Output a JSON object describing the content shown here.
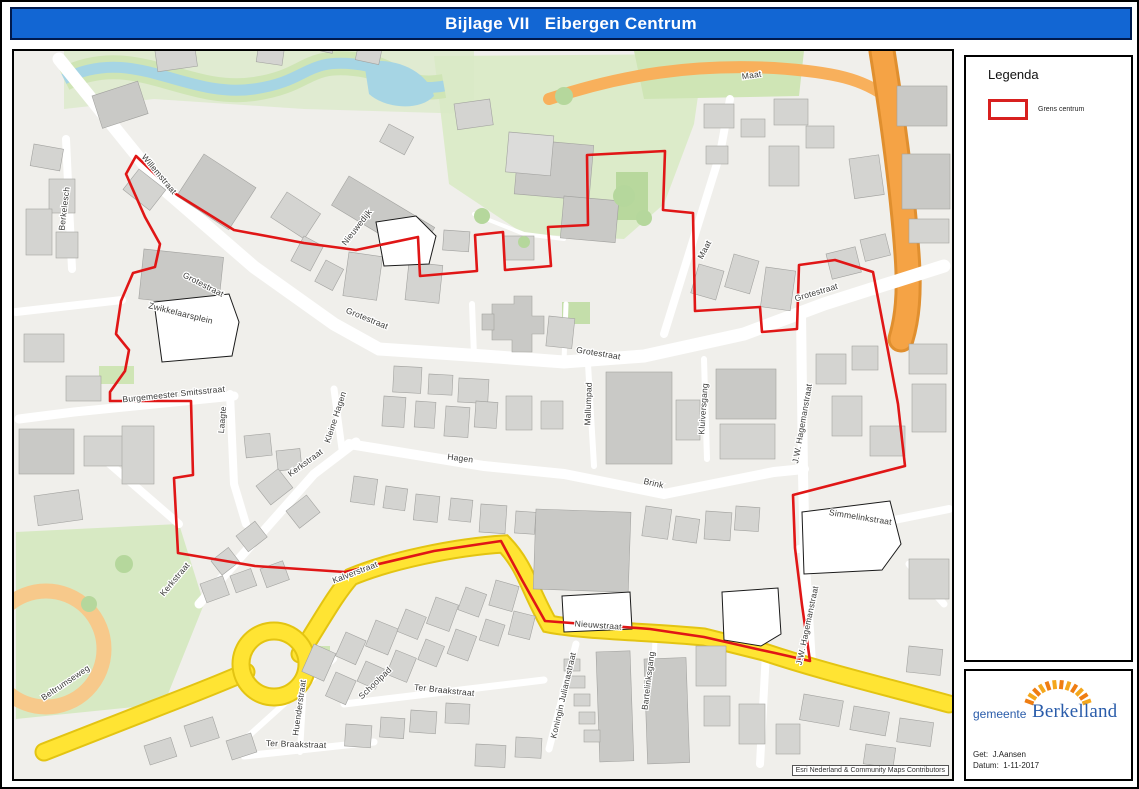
{
  "title_bar": {
    "text": "Bijlage VII   Eibergen Centrum",
    "bg_color": "#1266d3",
    "text_color": "#ffffff"
  },
  "legend": {
    "heading": "Legenda",
    "items": [
      {
        "label": "Grens centrum",
        "swatch_outline_color": "#d8201f"
      }
    ]
  },
  "footer_box": {
    "municipality_prefix": "gemeente",
    "municipality_name": "Berkelland",
    "logo_accent_color": "#f08a19",
    "logo_text_color": "#2a5caa",
    "drawn_by_line": "Get:  J.Aansen",
    "date_line": "Datum:  1-11-2017"
  },
  "map": {
    "attribution": "Esri Nederland & Community Maps Contributors",
    "boundary_name": "Grens centrum",
    "colors": {
      "boundary_red": "#e01616",
      "background": "#f0efeb",
      "building_gray": "#d4d4d1",
      "main_road_yellow": "#ffe433",
      "highway_orange": "#f5a345",
      "park_green": "#dcebc9",
      "river_blue": "#a6d5e4"
    },
    "labels": [
      {
        "text": "Berkelesch",
        "x": 63,
        "y": 205,
        "r": -83
      },
      {
        "text": "Willemstraat",
        "x": 153,
        "y": 172,
        "r": 50
      },
      {
        "text": "Grotestraat",
        "x": 198,
        "y": 283,
        "r": 27
      },
      {
        "text": "Zwikkelaarsplein",
        "x": 176,
        "y": 312,
        "r": 14
      },
      {
        "text": "Nieuwedijk",
        "x": 355,
        "y": 225,
        "r": -52
      },
      {
        "text": "Grotestraat",
        "x": 362,
        "y": 317,
        "r": 22
      },
      {
        "text": "Maat",
        "x": 748,
        "y": 74,
        "r": -8
      },
      {
        "text": "Grotestraat",
        "x": 594,
        "y": 352,
        "r": 9
      },
      {
        "text": "Maat",
        "x": 703,
        "y": 247,
        "r": -62
      },
      {
        "text": "Grotestraat",
        "x": 813,
        "y": 291,
        "r": -17
      },
      {
        "text": "Mallumpad",
        "x": 587,
        "y": 400,
        "r": -88
      },
      {
        "text": "Kluiversgang",
        "x": 702,
        "y": 405,
        "r": -86
      },
      {
        "text": "J.W. Hagemanstraat",
        "x": 801,
        "y": 420,
        "r": -80
      },
      {
        "text": "Burgemeester Smitsstraat",
        "x": 170,
        "y": 393,
        "r": -6
      },
      {
        "text": "Laagte",
        "x": 221,
        "y": 416,
        "r": -85
      },
      {
        "text": "Kleine Hagen",
        "x": 334,
        "y": 414,
        "r": -72
      },
      {
        "text": "Kerkstraat",
        "x": 303,
        "y": 461,
        "r": -36
      },
      {
        "text": "Hagen",
        "x": 456,
        "y": 457,
        "r": 7
      },
      {
        "text": "Brink",
        "x": 649,
        "y": 482,
        "r": 13
      },
      {
        "text": "Kerkstraat",
        "x": 173,
        "y": 577,
        "r": -50
      },
      {
        "text": "Kalverstraat",
        "x": 352,
        "y": 571,
        "r": -21
      },
      {
        "text": "Nieuwstraat",
        "x": 594,
        "y": 624,
        "r": 4
      },
      {
        "text": "Simmelinkstraat",
        "x": 856,
        "y": 516,
        "r": 9
      },
      {
        "text": "J.W. Hagemanstraat",
        "x": 806,
        "y": 622,
        "r": -78
      },
      {
        "text": "Beltrumseweg",
        "x": 63,
        "y": 681,
        "r": -34
      },
      {
        "text": "Huenderstraat",
        "x": 298,
        "y": 704,
        "r": -82
      },
      {
        "text": "Schoolpad",
        "x": 373,
        "y": 681,
        "r": -44
      },
      {
        "text": "Ter Braakstraat",
        "x": 440,
        "y": 689,
        "r": 6
      },
      {
        "text": "Ter Braakstraat",
        "x": 292,
        "y": 743,
        "r": 2
      },
      {
        "text": "Koningin Julianastraat",
        "x": 562,
        "y": 692,
        "r": -77
      },
      {
        "text": "Bartelinksgang",
        "x": 647,
        "y": 677,
        "r": -83
      }
    ]
  }
}
